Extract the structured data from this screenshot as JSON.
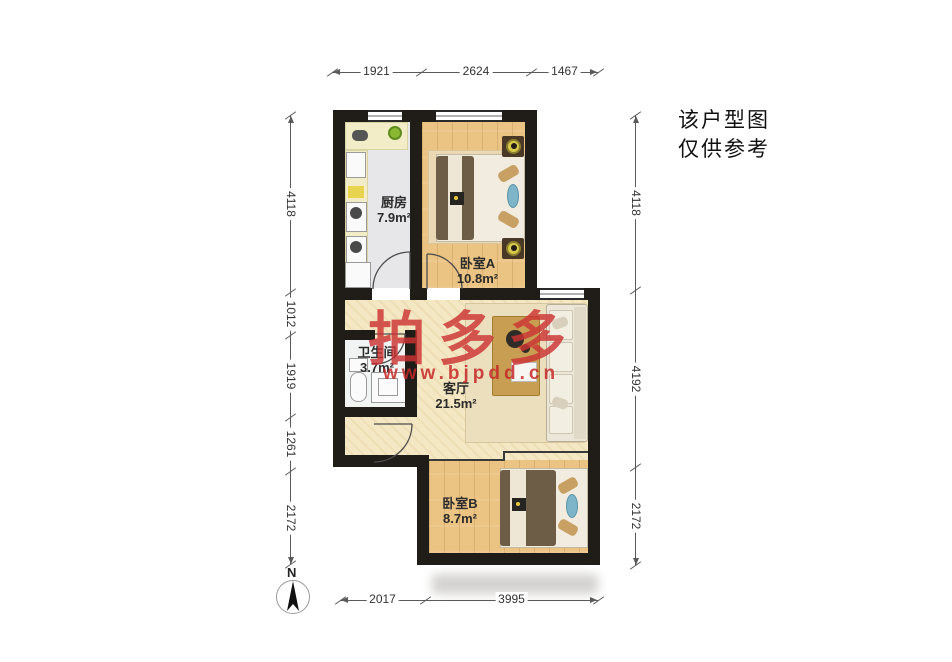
{
  "disclaimer": {
    "line1": "该户型图",
    "line2": "仅供参考"
  },
  "watermark": {
    "brand": "拍多多",
    "url": "www.bjpdd.cn"
  },
  "compass": {
    "label": "N"
  },
  "rooms": [
    {
      "name": "厨房",
      "area": "7.9m²"
    },
    {
      "name": "卧室A",
      "area": "10.8m²"
    },
    {
      "name": "卫生间",
      "area": "3.7m²"
    },
    {
      "name": "客厅",
      "area": "21.5m²"
    },
    {
      "name": "卧室B",
      "area": "8.7m²"
    }
  ],
  "dimensions": {
    "top": [
      "1921",
      "2624",
      "1467"
    ],
    "left": [
      "4118",
      "1012",
      "1919",
      "1261",
      "2172"
    ],
    "right": [
      "4118",
      "4192",
      "2172"
    ],
    "bottom": [
      "2017",
      "3995"
    ]
  },
  "colors": {
    "wall": "#201d19",
    "wood": "#ebc383",
    "cream": "#f4e7c3",
    "watermark_red": "#cc3333"
  }
}
